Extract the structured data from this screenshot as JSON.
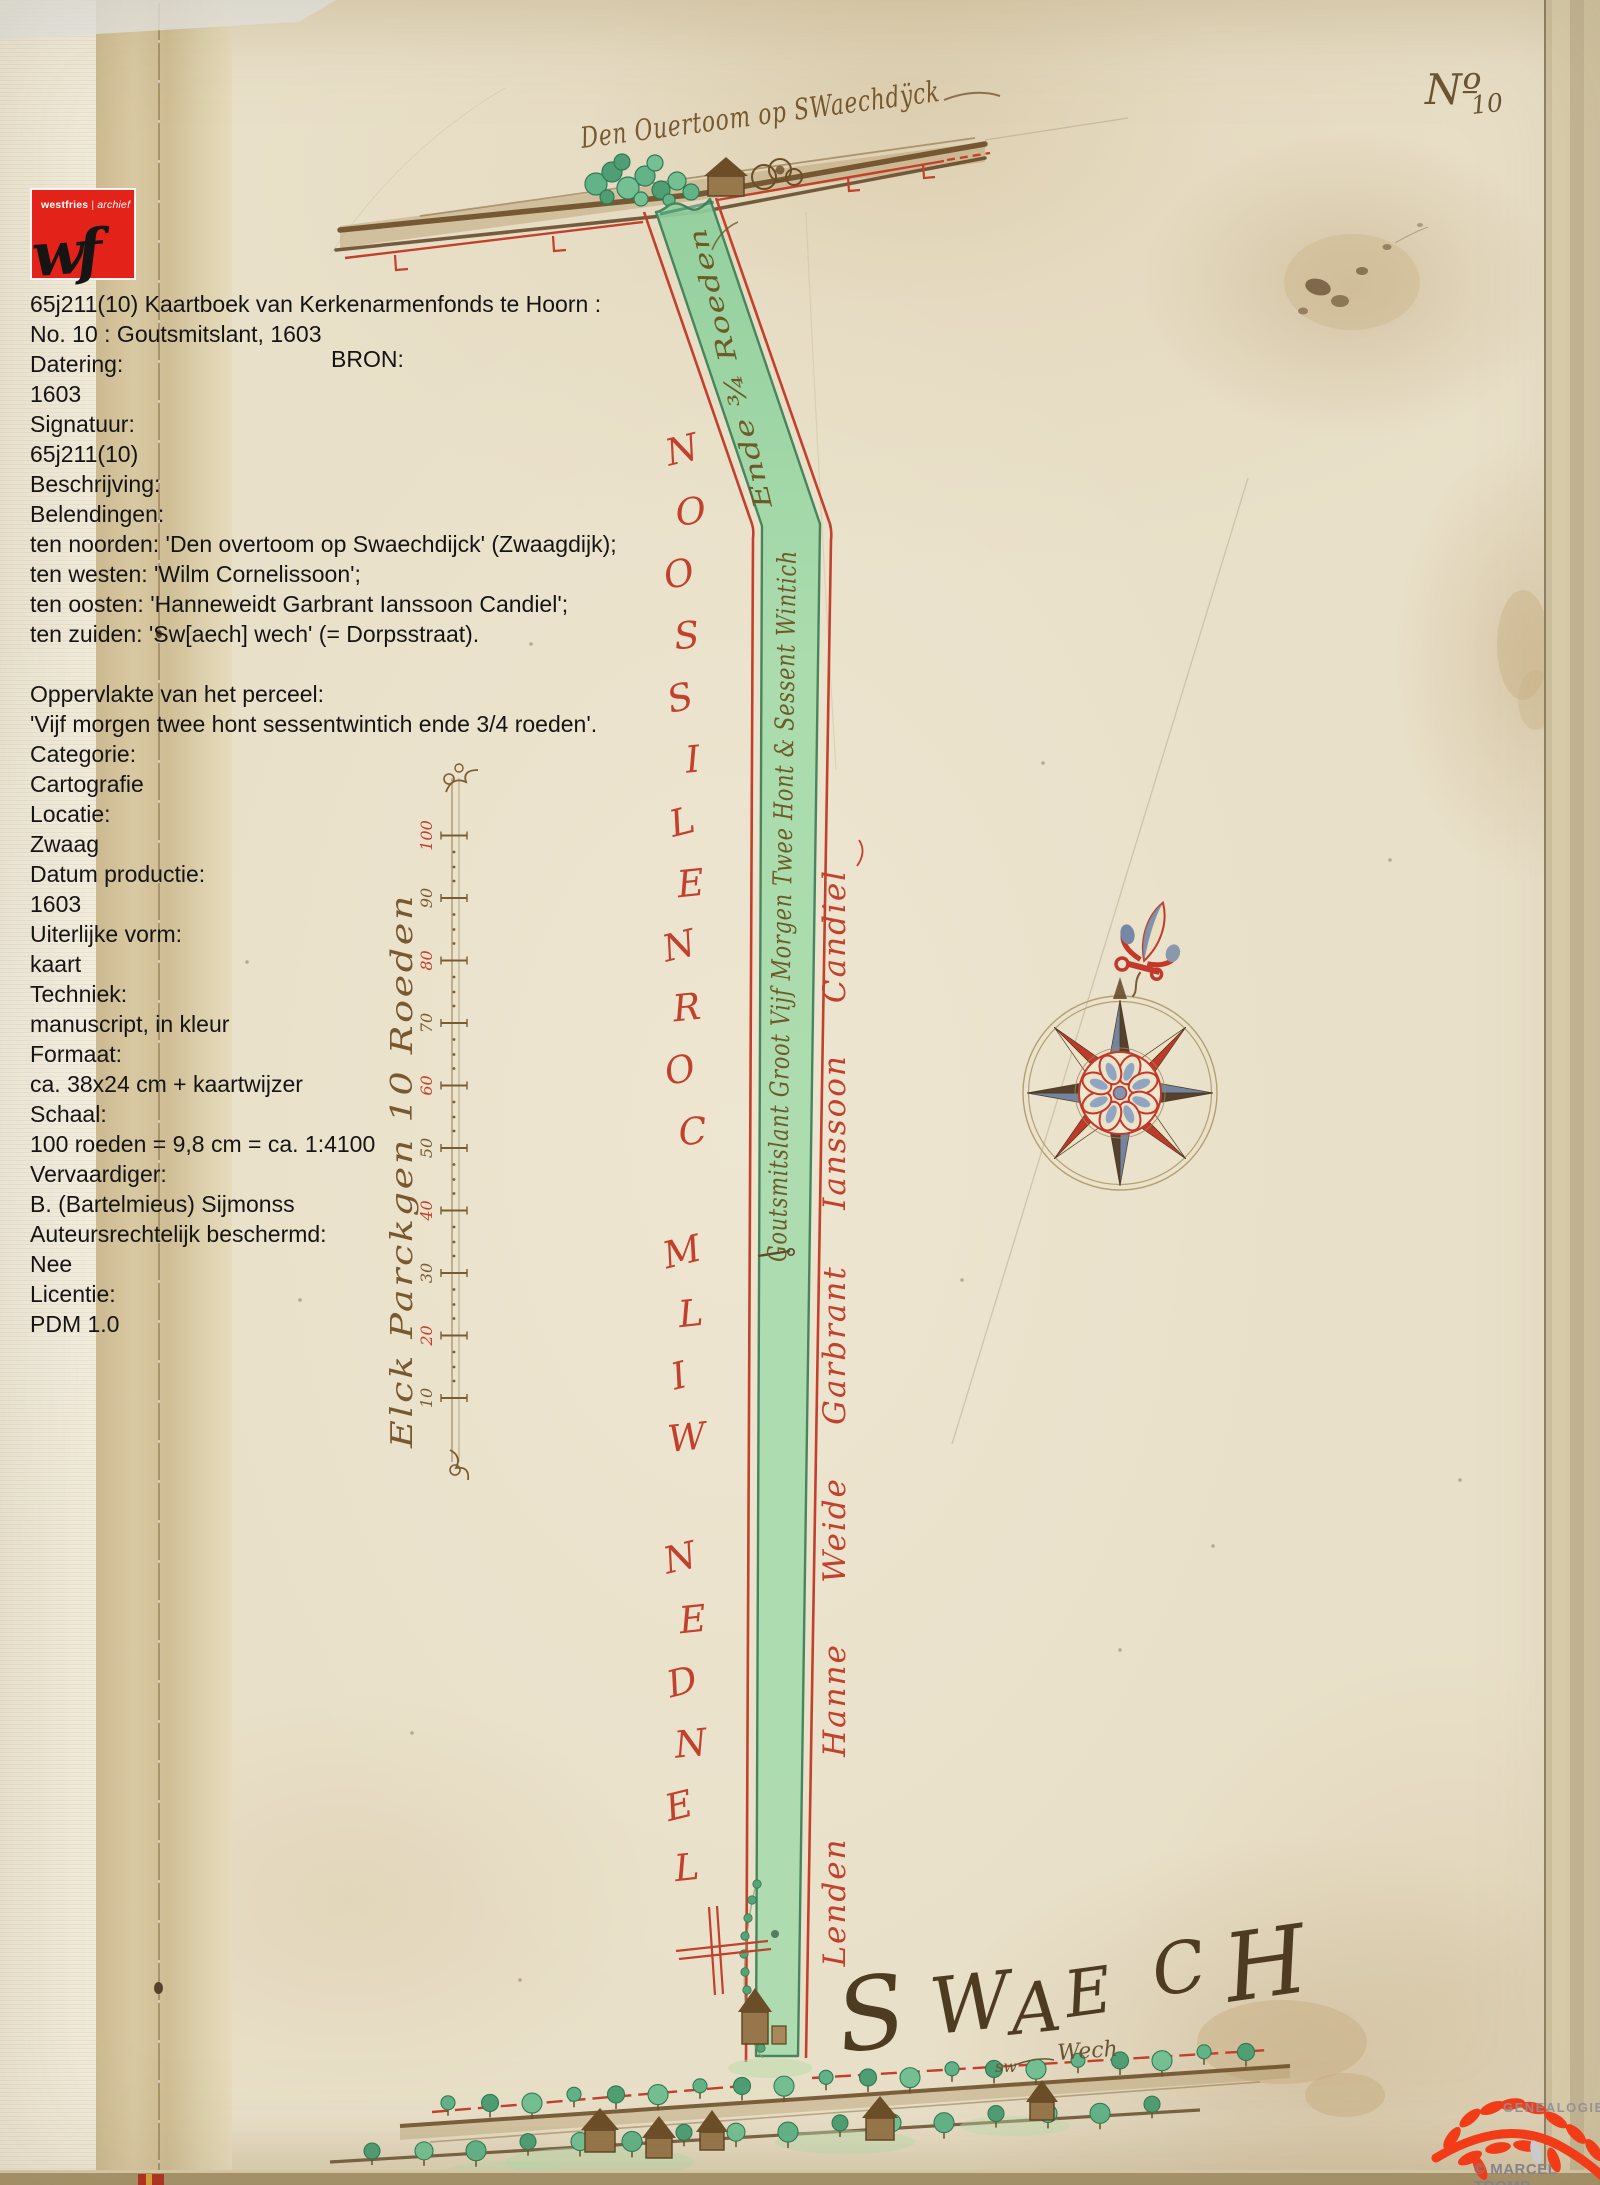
{
  "logo": {
    "brand": "westfries",
    "sep": "|",
    "dept": "archief",
    "monogram": "wf"
  },
  "info": {
    "bron_label": "BRON:",
    "lines": [
      "65j211(10) Kaartboek van Kerkenarmenfonds te Hoorn :",
      "No. 10 : Goutsmitslant, 1603",
      "Datering:",
      "1603",
      "Signatuur:",
      "65j211(10)",
      "Beschrijving:",
      "Belendingen:",
      "ten noorden: 'Den overtoom op Swaechdijck' (Zwaagdijk);",
      "ten westen: 'Wilm Cornelissoon';",
      "ten oosten: 'Hanneweidt Garbrant Ianssoon Candiel';",
      "ten zuiden: 'Sw[aech] wech' (= Dorpsstraat).",
      "",
      "Oppervlakte van het perceel:",
      "'Vijf morgen twee hont sessentwintich ende 3/4 roeden'.",
      "Categorie:",
      "Cartografie",
      "Locatie:",
      "Zwaag",
      "Datum productie:",
      "1603",
      "Uiterlijke vorm:",
      "kaart",
      "Techniek:",
      "manuscript, in kleur",
      "Formaat:",
      "ca. 38x24 cm + kaartwijzer",
      "Schaal:",
      "100 roeden = 9,8 cm = ca. 1:4100",
      "Vervaardiger:",
      "B. (Bartelmieus) Sijmonss",
      "Auteursrechtelijk beschermd:",
      "Nee",
      "Licentie:",
      "PDM 1.0"
    ]
  },
  "map": {
    "number_prefix": "Nº",
    "number_value": "10",
    "title": "Den Ouertoom op SWaechdÿck",
    "parcel_text": "Goutsmitslant Groot Vijf Morgen Twee Hont & Sessent Wintich",
    "parcel_text_top": "Ende ¾ Roeden",
    "west_boundary_letters": "LENDEN WILM CORNELISSOON",
    "east_boundary_words": [
      "Lenden",
      "Hanne",
      "Weide",
      "Garbrant",
      "Ianssoon",
      "Candiel"
    ],
    "village": "SWAECH",
    "road_small": "sw",
    "road_word": "Wech",
    "scale_label": "Elck Parckgen 10 Roeden",
    "scale_values": [
      "10",
      "20",
      "30",
      "40",
      "50",
      "60",
      "70",
      "80",
      "90",
      "100"
    ]
  },
  "watermark": {
    "name": "GENEALOGIEN",
    "credit": "© MARCEL TROMP"
  },
  "colors": {
    "logo_red": "#e3231a",
    "ink_red": "#c2402c",
    "ink_brown": "#77582f",
    "parcel_green": "#a3d9a8",
    "watermark_red": "#f23b17"
  }
}
